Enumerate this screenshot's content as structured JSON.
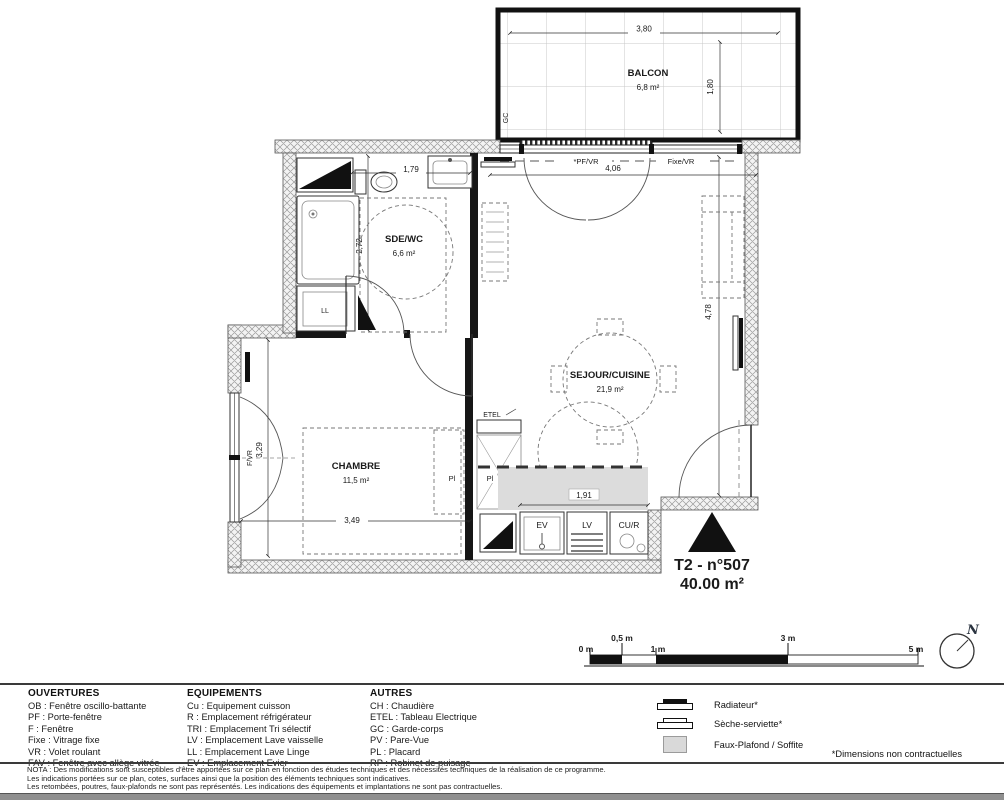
{
  "plan": {
    "balcony": {
      "label": "BALCON",
      "area": "6,8 m²",
      "dim_w": "3,80",
      "dim_h": "1,80",
      "gc": "GC"
    },
    "sde": {
      "label": "SDE/WC",
      "area": "6,6 m²",
      "dim_w": "1,79",
      "dim_h": "2,72",
      "ll": "LL"
    },
    "sejour": {
      "label": "SEJOUR/CUISINE",
      "area": "21,9 m²",
      "dim_w": "4,06",
      "dim_h": "4,78",
      "kitchen_dim": "1,91",
      "pf_vr": "*PF/VR",
      "fixe_vr": "Fixe/VR",
      "ev": "EV",
      "lv": "LV",
      "cur": "CU/R",
      "etel": "ETEL",
      "pl": "Pl"
    },
    "chambre": {
      "label": "CHAMBRE",
      "area": "11,5 m²",
      "dim_w": "3,49",
      "dim_h": "3,29",
      "f_vr": "F/VR",
      "pl": "Pl"
    },
    "title_line1": "T2 - n°507",
    "title_line2": "40.00 m²"
  },
  "scalebar": {
    "m0": "0 m",
    "m05": "0,5 m",
    "m1": "1 m",
    "m3": "3 m",
    "m5": "5 m",
    "north": "N"
  },
  "legend": {
    "ouvertures": {
      "header": "OUVERTURES",
      "items": [
        "OB : Fenêtre oscillo-battante",
        "PF : Porte-fenêtre",
        "F : Fenêtre",
        "Fixe : Vitrage fixe",
        "VR : Volet roulant",
        "FAV : Fenêtre avec allège vitrée"
      ]
    },
    "equipements": {
      "header": "EQUIPEMENTS",
      "items": [
        "Cu : Equipement cuisson",
        "R : Emplacement réfrigérateur",
        "TRI : Emplacement Tri sélectif",
        "LV : Emplacement Lave vaisselle",
        "LL : Emplacement Lave Linge",
        "EV : Emplacement Evier"
      ]
    },
    "autres": {
      "header": "AUTRES",
      "items": [
        "CH : Chaudière",
        "ETEL : Tableau Electrique",
        "GC : Garde-corps",
        "PV : Pare-Vue",
        "PL : Placard",
        "RP : Robinet de puisage"
      ]
    },
    "symbols": {
      "radiateur": "Radiateur*",
      "seche": "Sèche-serviette*",
      "faux_plafond": "Faux-Plafond / Soffite"
    },
    "footnote": "*Dimensions non contractuelles"
  },
  "nota": {
    "line1": "NOTA : Des modifications sont susceptibles d'être apportées sur ce plan en fonction des études techniques et des nécessités techniques de la réalisation de ce programme.",
    "line2": "Les indications portées sur ce plan, cotes, surfaces ainsi que la position des éléments techniques sont indicatives.",
    "line3": "Les retombées, poutres, faux-plafonds ne sont pas représentés. Les indications des équipements et implantations ne sont pas contractuelles."
  }
}
